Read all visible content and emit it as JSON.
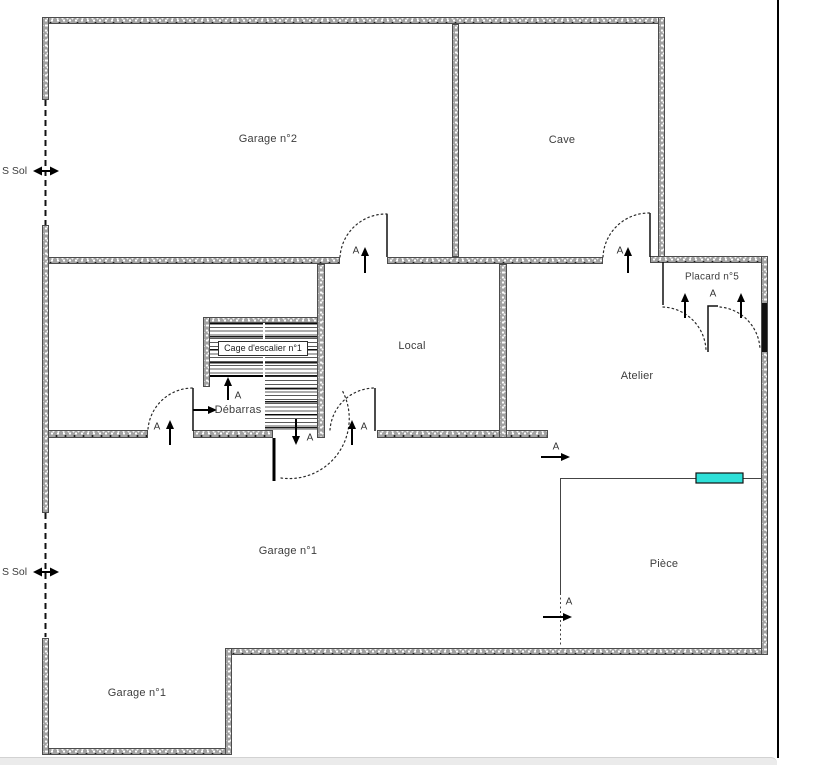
{
  "colors": {
    "window_accent": "#2ee0d8",
    "wall_fill": "#a2a2a2",
    "frame_line": "#000000",
    "bottom_bar": "#ebebeb"
  },
  "floorplan": {
    "rooms": [
      {
        "id": "garage2",
        "label": "Garage n°2"
      },
      {
        "id": "cave",
        "label": "Cave"
      },
      {
        "id": "placard5",
        "label": "Placard n°5"
      },
      {
        "id": "local",
        "label": "Local"
      },
      {
        "id": "atelier",
        "label": "Atelier"
      },
      {
        "id": "stairwell",
        "label": "Cage d'escalier n°1"
      },
      {
        "id": "debarras",
        "label": "Débarras"
      },
      {
        "id": "garage1_main",
        "label": "Garage n°1"
      },
      {
        "id": "piece",
        "label": "Pièce"
      },
      {
        "id": "garage1_annex",
        "label": "Garage n°1"
      }
    ],
    "level_markers": [
      {
        "id": "ssol_top",
        "label": "S Sol"
      },
      {
        "id": "ssol_bottom",
        "label": "S Sol"
      }
    ],
    "door_label": "A"
  }
}
